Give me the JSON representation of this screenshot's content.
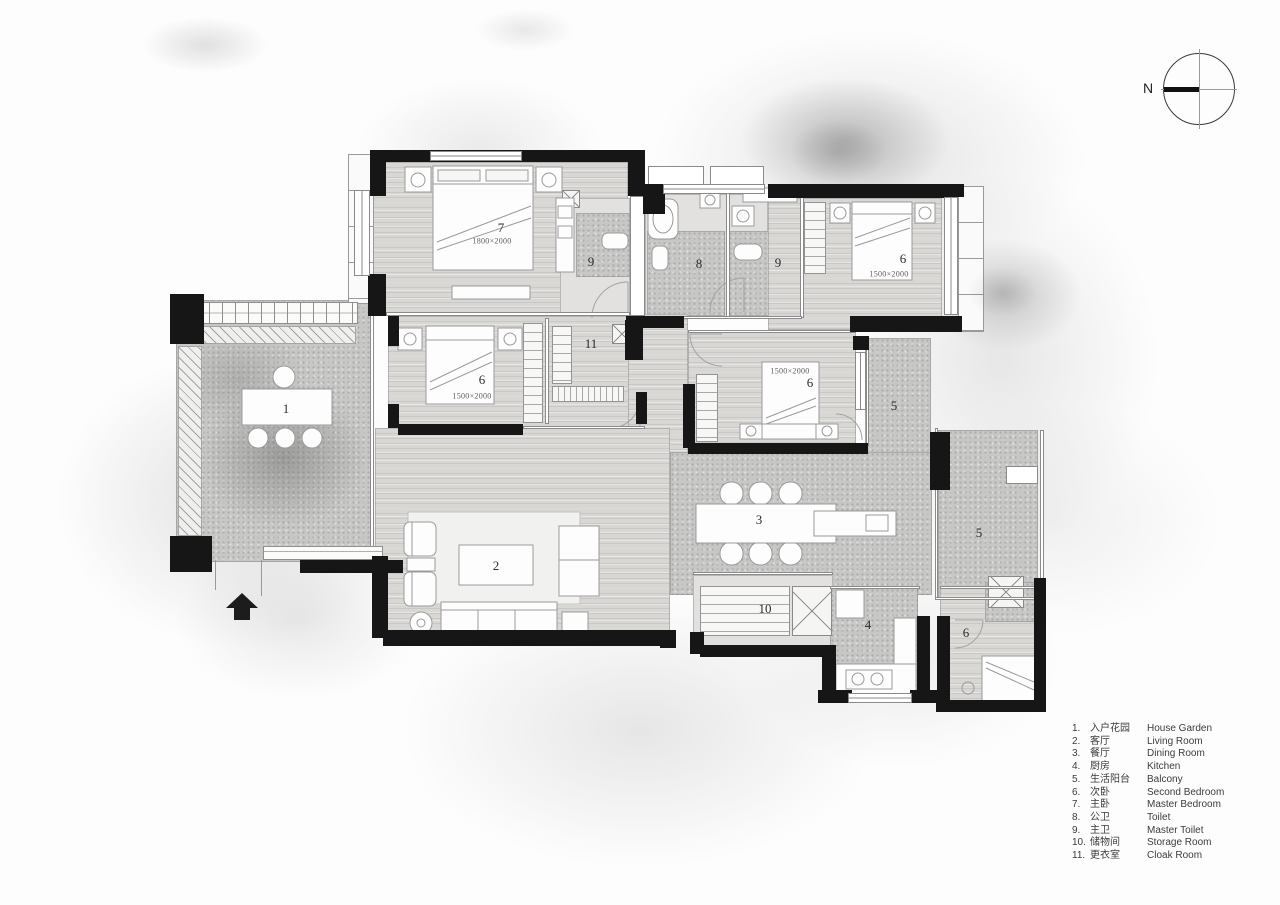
{
  "compass": {
    "north_label": "N"
  },
  "plan": {
    "room_labels": [
      {
        "text": "7"
      },
      {
        "text": "1800×2000"
      },
      {
        "text": "9"
      },
      {
        "text": "8"
      },
      {
        "text": "9"
      },
      {
        "text": "6"
      },
      {
        "text": "1500×2000"
      },
      {
        "text": "1"
      },
      {
        "text": "6"
      },
      {
        "text": "1500×2000"
      },
      {
        "text": "11"
      },
      {
        "text": "1500×2000"
      },
      {
        "text": "6"
      },
      {
        "text": "5"
      },
      {
        "text": "2"
      },
      {
        "text": "3"
      },
      {
        "text": "5"
      },
      {
        "text": "10"
      },
      {
        "text": "4"
      },
      {
        "text": "6"
      }
    ]
  },
  "legend": {
    "items": [
      {
        "num": "1.",
        "zh": "入户花园",
        "en": "House Garden"
      },
      {
        "num": "2.",
        "zh": "客厅",
        "en": "Living Room"
      },
      {
        "num": "3.",
        "zh": "餐厅",
        "en": "Dining Room"
      },
      {
        "num": "4.",
        "zh": "厨房",
        "en": "Kitchen"
      },
      {
        "num": "5.",
        "zh": "生活阳台",
        "en": "Balcony"
      },
      {
        "num": "6.",
        "zh": "次卧",
        "en": "Second Bedroom"
      },
      {
        "num": "7.",
        "zh": "主卧",
        "en": "Master Bedroom"
      },
      {
        "num": "8.",
        "zh": "公卫",
        "en": "Toilet"
      },
      {
        "num": "9.",
        "zh": "主卫",
        "en": "Master Toilet"
      },
      {
        "num": "10.",
        "zh": "储物间",
        "en": "Storage Room"
      },
      {
        "num": "11.",
        "zh": "更衣室",
        "en": "Cloak Room"
      }
    ]
  }
}
